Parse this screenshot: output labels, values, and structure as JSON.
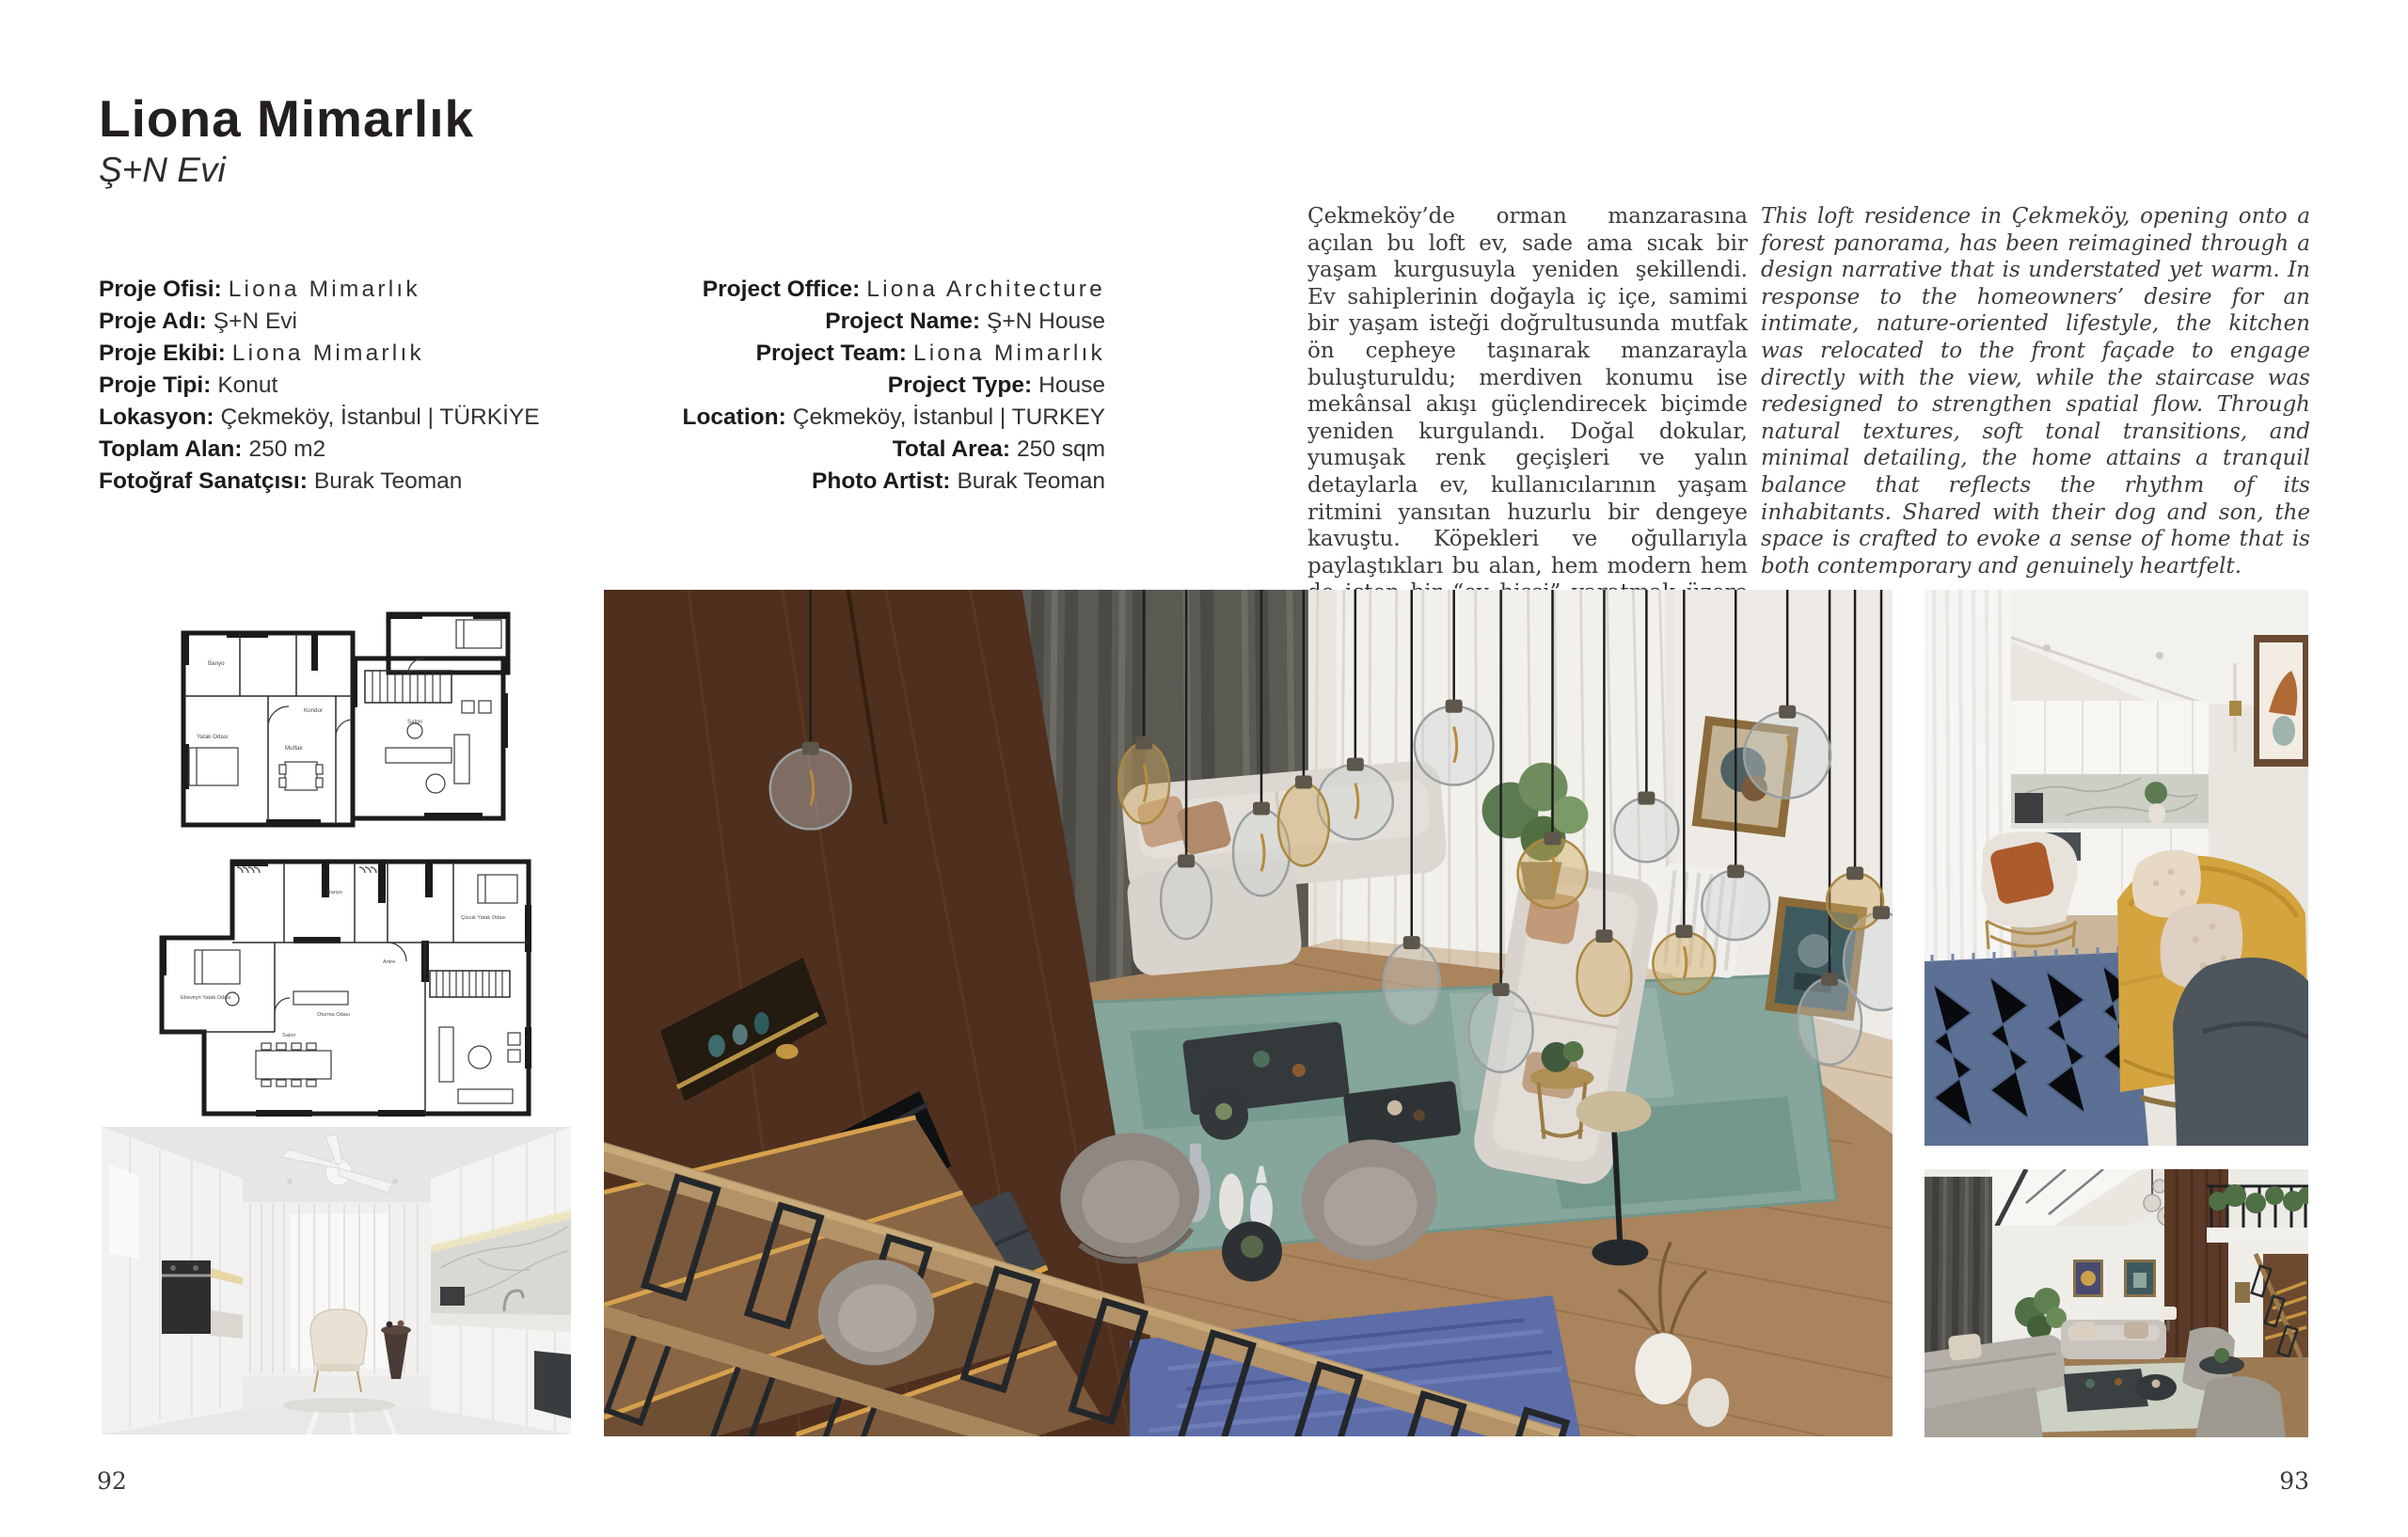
{
  "page": {
    "left_page_number": "92",
    "right_page_number": "93"
  },
  "header": {
    "title": "Liona Mimarlık",
    "subtitle": "Ş+N Evi"
  },
  "info_tr": {
    "rows": [
      {
        "label": "Proje Ofisi:",
        "value": "Liona Mimarlık"
      },
      {
        "label": "Proje Adı:",
        "value": "Ş+N Evi"
      },
      {
        "label": "Proje Ekibi:",
        "value": "Liona Mimarlık"
      },
      {
        "label": "Proje Tipi:",
        "value": "Konut"
      },
      {
        "label": "Lokasyon:",
        "value": "Çekmeköy, İstanbul | TÜRKİYE"
      },
      {
        "label": "Toplam Alan:",
        "value": "250 m2"
      },
      {
        "label": "Fotoğraf Sanatçısı:",
        "value": "Burak Teoman"
      }
    ]
  },
  "info_en": {
    "rows": [
      {
        "label": "Project Office:",
        "value": "Liona Architecture"
      },
      {
        "label": "Project Name:",
        "value": "Ş+N House"
      },
      {
        "label": "Project Team:",
        "value": "Liona Mimarlık"
      },
      {
        "label": "Project Type:",
        "value": "House"
      },
      {
        "label": "Location:",
        "value": "Çekmeköy, İstanbul | TURKEY"
      },
      {
        "label": "Total Area:",
        "value": "250 sqm"
      },
      {
        "label": "Photo Artist:",
        "value": "Burak Teoman"
      }
    ]
  },
  "body_tr": "Çekmeköy’de orman manzarasına açılan bu loft ev, sade ama sıcak bir yaşam kurgusuyla yeniden şekillendi. Ev sahiplerinin doğayla iç içe, samimi bir yaşam isteği doğrultusunda mutfak ön cepheye taşınarak manzarayla buluşturuldu; merdiven konumu ise mekânsal akışı güçlendirecek biçimde yeniden kurgulandı. Doğal dokular, yumuşak renk geçişleri ve yalın detaylarla ev, kullanıcılarının yaşam ritmini yansıtan huzurlu bir dengeye kavuştu. Köpekleri ve oğullarıyla paylaştıkları bu alan, hem modern hem de içten bir “ev hissi” yaratmak üzere tasarlandı.",
  "body_en": "This loft residence in Çekmeköy, opening onto a forest panorama, has been reimagined through a design narrative that is understated yet warm. In response to the homeowners’ desire for an intimate, nature-oriented lifestyle, the kitchen was relocated to the front façade to engage directly with the view, while the staircase was redesigned to strengthen spatial flow. Through natural textures, soft tonal transitions, and minimal detailing, the home attains a tranquil balance that reflects the rhythm of its inhabitants. Shared with their dog and son, the space is crafted to evoke a sense of home that is both contemporary and genuinely heartfelt.",
  "plan1": {
    "labels": {
      "bedroom": "Yatak Odası",
      "bath": "Banyo",
      "corridor": "Koridor",
      "living": "Salon",
      "kitchen": "Mutfak"
    }
  },
  "plan2": {
    "labels": {
      "master": "Ebeveyn Yatak Odası",
      "lounge": "Oturma Odası",
      "living": "Salon",
      "kid": "Çocuk Yatak Odası",
      "hall": "Antre",
      "bath": "Banyo"
    }
  },
  "colors": {
    "accent_wood": "#4f2f1e",
    "curtain_gray": "#5a5952",
    "rug_teal": "#86a59b",
    "rug_blue": "#5d6da8",
    "sofa_yellow": "#d4a43e",
    "rug_blue_small": "#5b7094",
    "floor_wood": "#a9845c"
  }
}
